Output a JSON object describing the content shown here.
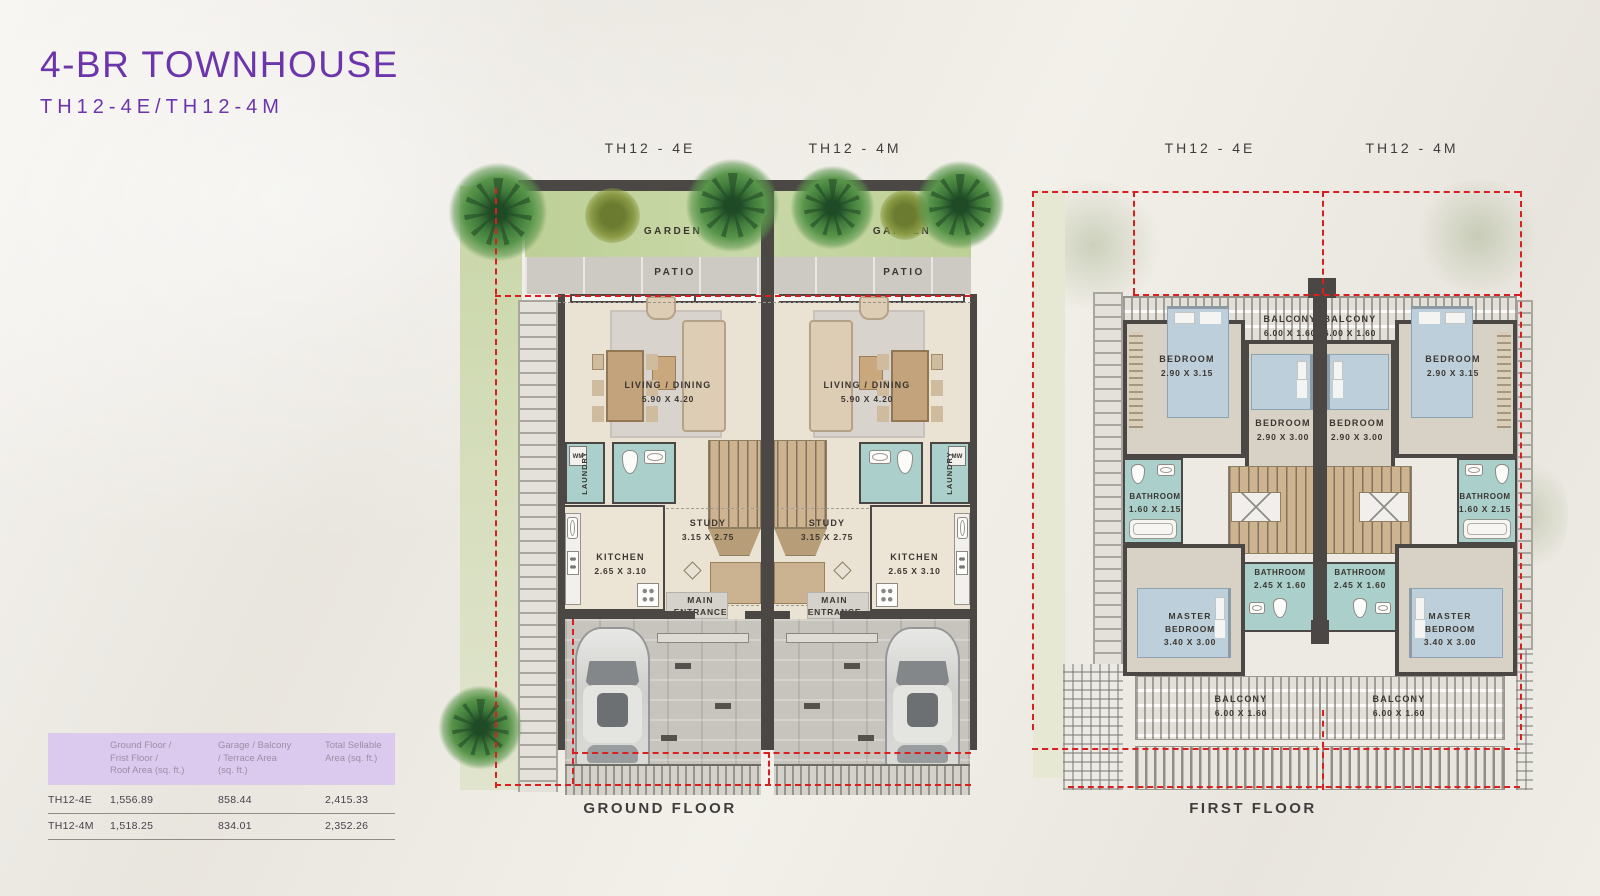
{
  "page": {
    "title": "4-BR TOWNHOUSE",
    "subtitle": "TH12-4E/TH12-4M"
  },
  "plans": {
    "ground": {
      "label_left": "TH12 - 4E",
      "label_right": "TH12 - 4M",
      "caption": "GROUND FLOOR"
    },
    "first": {
      "label_left": "TH12 - 4E",
      "label_right": "TH12 - 4M",
      "caption": "FIRST FLOOR"
    }
  },
  "rooms": {
    "garden": "GARDEN",
    "patio": "PATIO",
    "living": "LIVING / DINING",
    "living_dim": "5.90 X 4.20",
    "laundry": "LAUNDRY",
    "wm": "WM",
    "study": "STUDY",
    "study_dim": "3.15 X 2.75",
    "kitchen": "KITCHEN",
    "kitchen_dim": "2.65 X 3.10",
    "entrance_l1": "MAIN",
    "entrance_l2": "ENTRANCE",
    "balcony": "BALCONY",
    "balcony_dim": "6.00 X 1.60",
    "bedroom": "BEDROOM",
    "bedroom_outer_dim": "2.90 X 3.15",
    "bedroom_inner_dim": "2.90 X 3.00",
    "bathroom": "BATHROOM",
    "bathroom_side_dim": "1.60 X 2.15",
    "bathroom_center_dim": "2.45 X 1.60",
    "master_l1": "MASTER",
    "master_l2": "BEDROOM",
    "master_dim": "3.40 X 3.00"
  },
  "area_table": {
    "columns": [
      "Ground Floor /\nFrist Floor /\nRoof Area (sq. ft.)",
      "Garage / Balcony\n/ Terrace Area\n(sq. ft.)",
      "Total Sellable\nArea (sq. ft.)"
    ],
    "rows": [
      {
        "unit": "TH12-4E",
        "values": [
          "1,556.89",
          "858.44",
          "2,415.33"
        ]
      },
      {
        "unit": "TH12-4M",
        "values": [
          "1,518.25",
          "834.01",
          "2,352.26"
        ]
      }
    ]
  },
  "colors": {
    "accent_purple": "#6c35ab",
    "table_header_bg": "#dccaee",
    "boundary_red": "#d92020",
    "wall_dark": "#4a4744",
    "garden_green": "#c4d3a0",
    "wet_room_teal": "#abd0cb"
  }
}
